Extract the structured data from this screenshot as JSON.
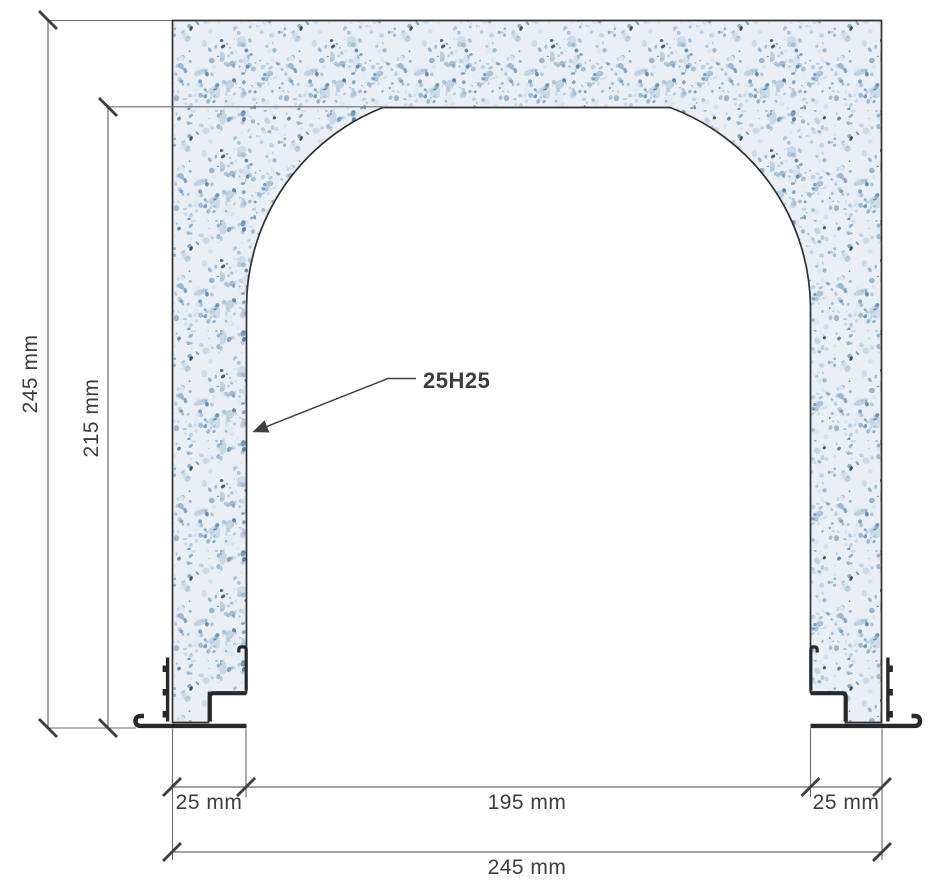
{
  "diagram": {
    "kind": "concrete-arch-cross-section",
    "labels": {
      "outer_height": "245 mm",
      "inner_height": "215 mm",
      "left_wall": "25 mm",
      "opening_width": "195 mm",
      "right_wall": "25 mm",
      "outer_width": "245 mm",
      "callout": "25H25"
    },
    "colors": {
      "outline": "#303030",
      "dim_line": "#6b6b6b",
      "tick": "#3f3f3f",
      "text": "#3d3d3d",
      "metal": "#26282a",
      "texture_base": "#e9eff5",
      "speckles": [
        "#c6d8e7",
        "#a8c4da",
        "#8fb2cf",
        "#6f99bd",
        "#5d87ac",
        "#d8e4ee",
        "#b3cbde",
        "#7ea9c9"
      ],
      "speckles_dark": [
        "#23453c",
        "#2a4a66",
        "#17394a"
      ]
    }
  }
}
